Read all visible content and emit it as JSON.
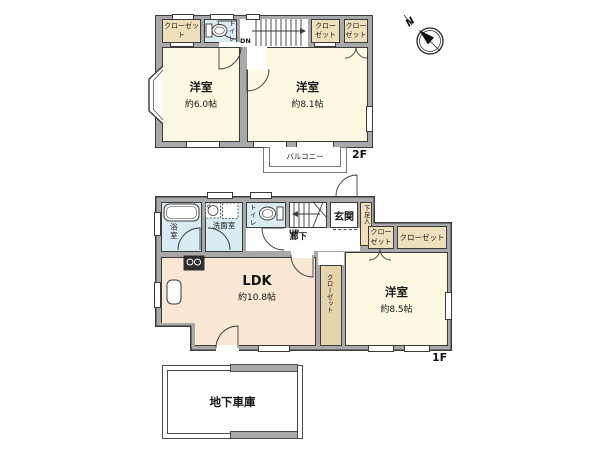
{
  "compass": {
    "north_label": "N"
  },
  "floor2": {
    "floor_label": "2F",
    "closet_left": "クローゼット",
    "closet_mid": "クローゼット",
    "closet_right": "クローゼット",
    "toilet_label": "トイレ",
    "stairs_label": "DN",
    "room_west": {
      "name": "洋室",
      "area": "約6.0帖"
    },
    "room_east": {
      "name": "洋室",
      "area": "約8.1帖"
    },
    "balcony_label": "バルコニー"
  },
  "floor1": {
    "floor_label": "1F",
    "bath_label": "浴室",
    "washroom_label": "洗面室",
    "washer_label": "洗",
    "toilet_label": "トイレ",
    "stairs_label": "UP",
    "entrance_label": "玄関",
    "shoe_cabinet_label": "下足入",
    "hallway_label": "廊下",
    "closet_hall": "クローゼット",
    "closet_east": "クローゼット",
    "closet_mid": "クローゼット",
    "ldk": {
      "name": "LDK",
      "area": "約10.8帖"
    },
    "room_east": {
      "name": "洋室",
      "area": "約8.5帖"
    }
  },
  "basement": {
    "garage_label": "地下車庫"
  },
  "colors": {
    "wall": "#a9a9a9",
    "room_cream": "#fdf8e2",
    "ldk_peach": "#fae8d4",
    "wet_blue": "#d9ecf4",
    "closet_tan": "#eee0bb"
  }
}
